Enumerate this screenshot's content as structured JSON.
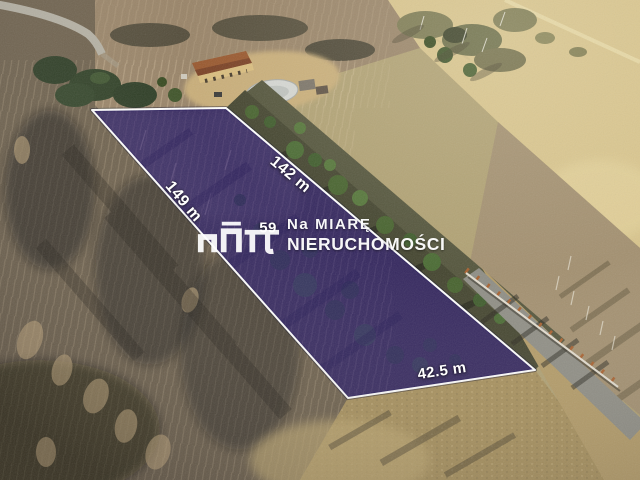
{
  "overlay": {
    "fill_color": "rgba(50,28,135,0.55)",
    "border_color": "#ffffff",
    "label_color": "#ffffff",
    "measurements": [
      {
        "edge": "top",
        "text": "142 m"
      },
      {
        "edge": "left",
        "text": "149 m"
      },
      {
        "edge": "bottom",
        "text": "42.5 m"
      },
      {
        "edge": "center",
        "text": "59"
      }
    ]
  },
  "watermark": {
    "logo_icon": "na-miare-monogram-icon",
    "line1": "Na MIARĘ",
    "line2": "NIERUCHOMOŚCI",
    "text_color": "#ffffff"
  }
}
